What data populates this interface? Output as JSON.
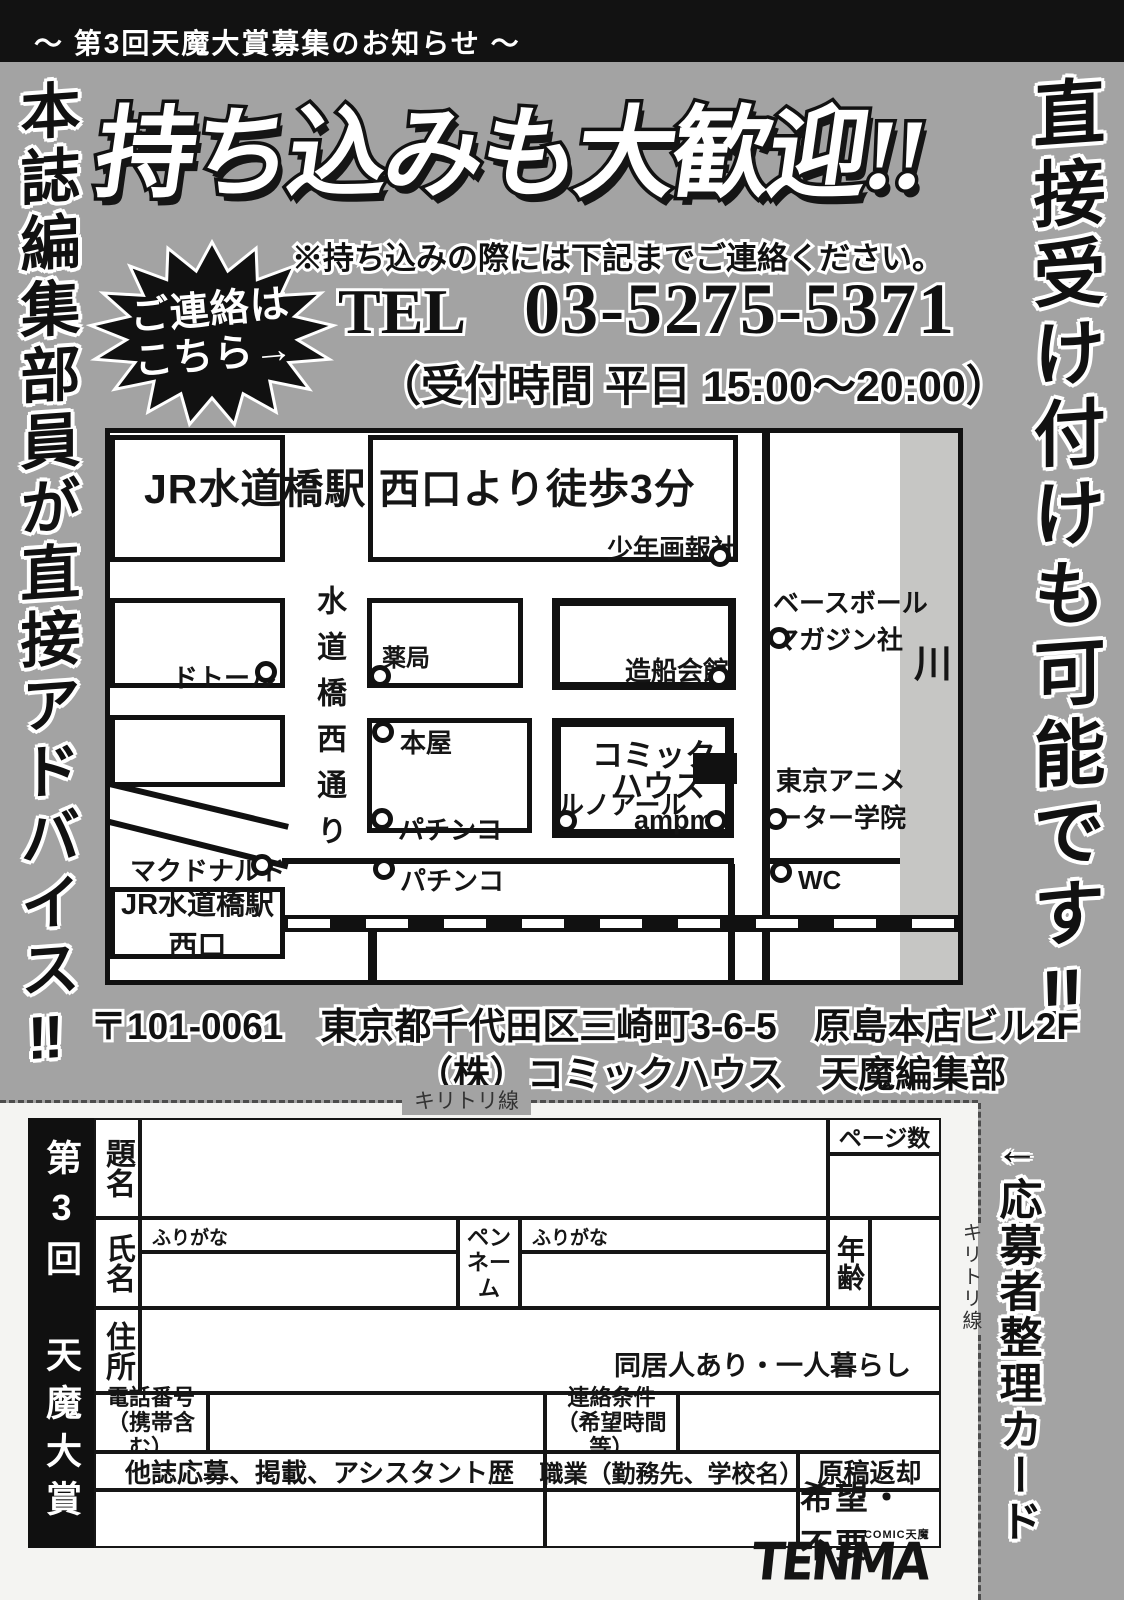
{
  "banner": {
    "text": "〜 第3回天魔大賞募集のお知らせ 〜"
  },
  "slogans": {
    "left": "本誌編集部員が直接アドバイス‼",
    "right": "直接受け付けも可能です‼"
  },
  "title": "持ち込みも大歓迎!!",
  "contact": {
    "burst_line1": "ご連絡は",
    "burst_line2": "こちら→",
    "notice": "※持ち込みの際には下記までご連絡ください。",
    "tel_label": "TEL",
    "tel_number": "03-5275-5371",
    "hours": "（受付時間 平日 15:00〜20:00）"
  },
  "map": {
    "header": "JR水道橋駅 西口より徒歩3分",
    "street_vertical": "水道橋西通り",
    "river": "川",
    "labels": {
      "shonen_gahosha": "少年画報社",
      "baseball_l1": "ベースボール",
      "baseball_l2": "マガジン社",
      "dotour": "ドトール",
      "yakkyoku": "薬局",
      "zousen_kaikan": "造船会館",
      "honya": "本屋",
      "pachinko1": "パチンコ",
      "comic_l1": "コミック",
      "comic_l2": "ハウス",
      "lenoir": "ルノアール",
      "ampm": "ampm",
      "anime_l1": "東京アニメ",
      "anime_l2": "ーター学院",
      "mcdonalds": "マクドナルド",
      "pachinko2": "パチンコ",
      "wc": "WC",
      "station_l1": "JR水道橋駅",
      "station_l2": "西口"
    }
  },
  "address": {
    "line1": "〒101-0061　東京都千代田区三崎町3-6-5　原島本店ビル2F",
    "line2": "（株）コミックハウス　天魔編集部"
  },
  "cutline": {
    "horizontal_label": "キリトリ線",
    "vertical_label": "キリトリ線",
    "card_label": "←応募者整理カード"
  },
  "form": {
    "banner": "第3回　天魔大賞",
    "fields": {
      "title": "題名",
      "pages": "ページ数",
      "name": "氏名",
      "furigana_name": "ふりがな",
      "furigana_pen": "ふりがな",
      "penname_l1": "ペン",
      "penname_l2": "ネーム",
      "age": "年齢",
      "address": "住所",
      "living": "同居人あり・一人暮らし",
      "phone_l1": "電話番号",
      "phone_l2": "（携帯含む）",
      "contact_l1": "連絡条件",
      "contact_l2": "（希望時間等）",
      "history": "他誌応募、掲載、アシスタント歴",
      "occupation": "職業（勤務先、学校名）",
      "manuscript": "原稿返却",
      "manuscript_options": "希望・不要"
    }
  },
  "logo": {
    "text": "TENMA",
    "sub": "COMIC天魔"
  }
}
